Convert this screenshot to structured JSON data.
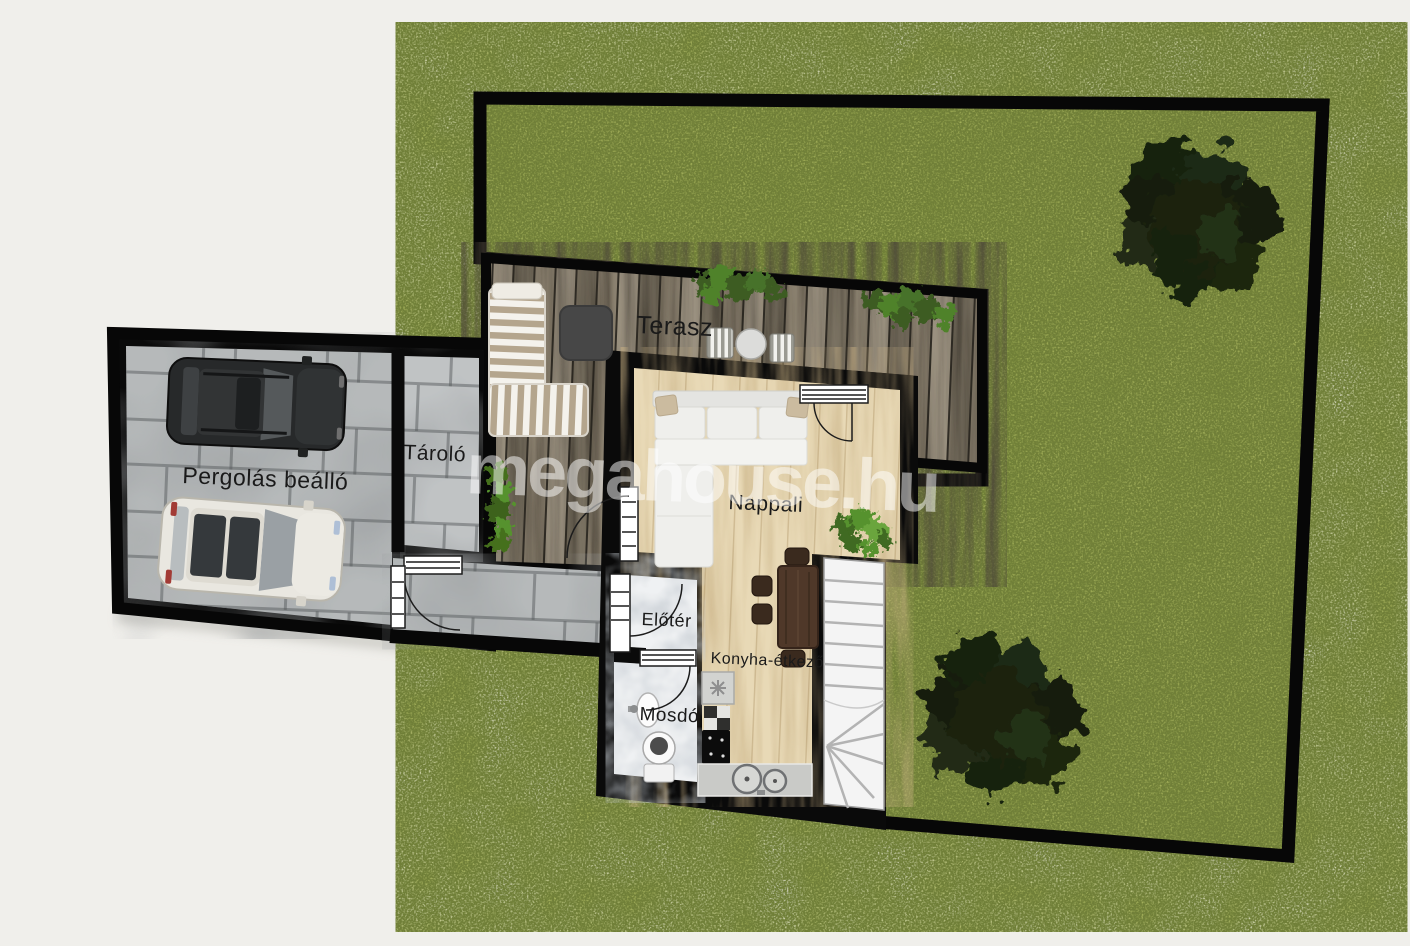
{
  "watermark": {
    "text": "megahouse.hu"
  },
  "rooms": [
    {
      "name": "terrace",
      "label": "Terasz"
    },
    {
      "name": "living-room",
      "label": "Nappali"
    },
    {
      "name": "kitchen-dining",
      "label": "Konyha-étkező"
    },
    {
      "name": "entry-hall",
      "label": "Előtér"
    },
    {
      "name": "washroom",
      "label": "Mosdó"
    },
    {
      "name": "storage",
      "label": "Tároló"
    },
    {
      "name": "pergola-carport",
      "label": "Pergolás beálló"
    }
  ],
  "colors": {
    "background": "#f0efeb",
    "wall": "#0a0a0a",
    "grass": "#93a24d",
    "deck_wood": "#8b8170",
    "paving": "#b6b9ba",
    "interior_floor": "#e8d9b6",
    "marble_floor": "#eff1f3",
    "tree": "#1a2312",
    "label_text": "#1a1a1a",
    "watermark": "rgba(255,255,255,0.5)"
  }
}
